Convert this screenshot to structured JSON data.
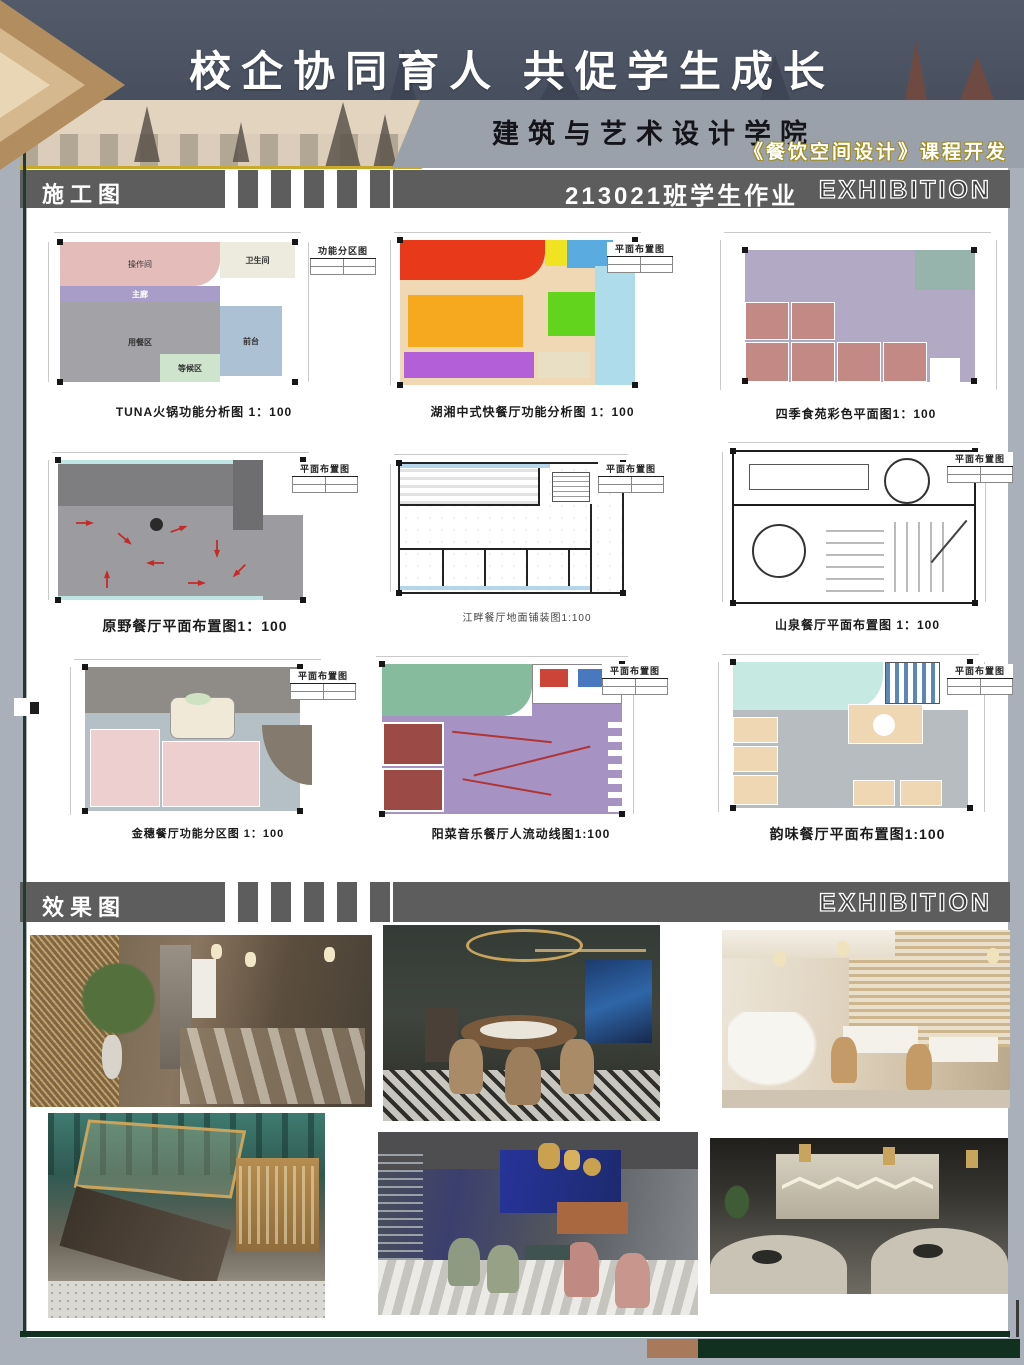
{
  "header": {
    "main_title": "校企协同育人 共促学生成长",
    "college": "建筑与艺术设计学院",
    "course": "《餐饮空间设计》课程开发"
  },
  "sections": {
    "construction": {
      "label": "施工图",
      "class_line": "213021班学生作业",
      "exhibition": "EXHIBITION"
    },
    "renders": {
      "label": "效果图",
      "exhibition": "EXHIBITION"
    }
  },
  "plans": [
    {
      "caption": "TUNA火锅功能分析图 1：100",
      "legend": "功能分区图",
      "zones": [
        "操作间",
        "卫生间",
        "主廊",
        "用餐区",
        "等候区",
        "前台"
      ]
    },
    {
      "caption": "湖湘中式快餐厅功能分析图 1：100",
      "legend": "平面布置图"
    },
    {
      "caption": "四季食苑彩色平面图1：100"
    },
    {
      "caption": "原野餐厅平面布置图1：100",
      "legend": "平面布置图"
    },
    {
      "caption": "江畔餐厅地面铺装图1:100",
      "legend": "平面布置图"
    },
    {
      "caption": "山泉餐厅平面布置图 1：100",
      "legend": "平面布置图"
    },
    {
      "caption": "金穗餐厅功能分区图 1：100",
      "legend": "平面布置图"
    },
    {
      "caption": "阳菜音乐餐厅人流动线图1:100",
      "legend": "平面布置图"
    },
    {
      "caption": "韵味餐厅平面布置图1:100",
      "legend": "平面布置图"
    }
  ],
  "colors": {
    "header_blue": "#4d5565",
    "band_gray": "#5d5d5d",
    "accent_gold": "#c9a82c",
    "chevron_tan": "#b28d5f",
    "footer_green": "#12301f",
    "footer_brown": "#a87a5b",
    "page_gray": "#aab0b9"
  }
}
